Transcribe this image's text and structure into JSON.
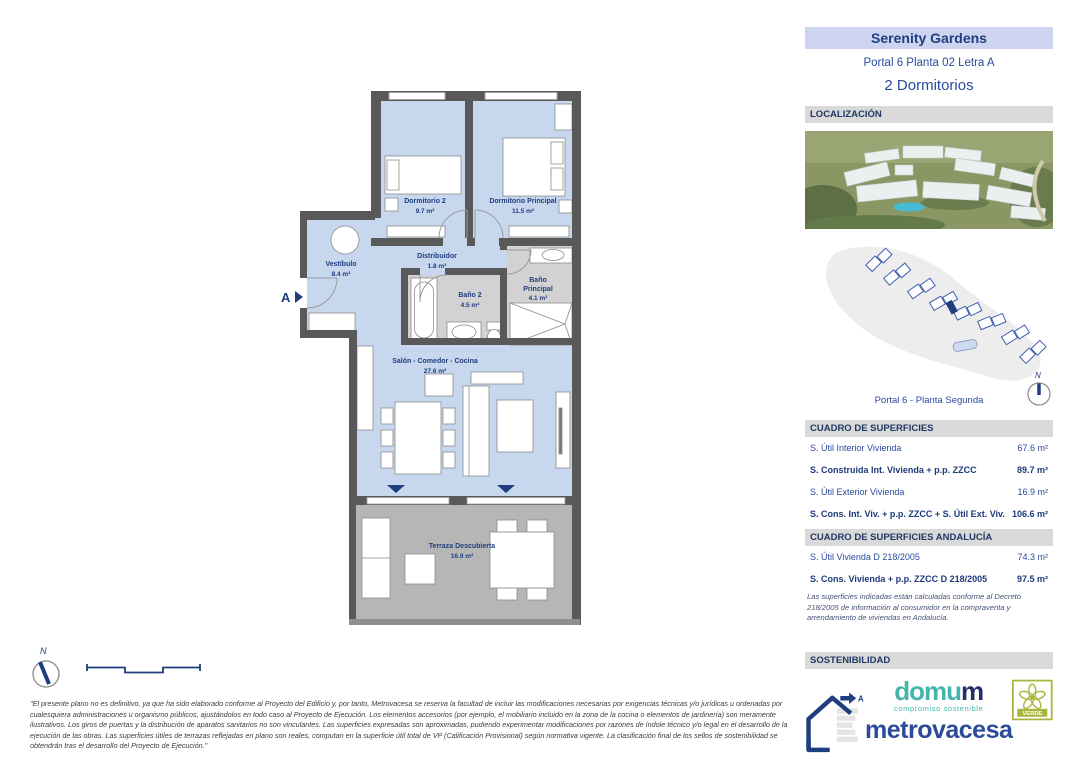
{
  "header": {
    "title": "Serenity Gardens",
    "subtitle": "Portal 6 Planta 02 Letra A",
    "bedrooms": "2 Dormitorios"
  },
  "localizacion": {
    "section_title": "LOCALIZACIÓN",
    "caption": "Portal 6 - Planta Segunda",
    "compass_label": "N"
  },
  "floor_plan": {
    "entrance_label": "A",
    "compass_label": "N",
    "rooms": [
      {
        "name": "Dormitorio 2",
        "area": "9.7 m²"
      },
      {
        "name": "Dormitorio Principal",
        "area": "11.5 m²"
      },
      {
        "name": "Vestíbulo",
        "area": "8.4 m²"
      },
      {
        "name": "Distribuidor",
        "area": "1.8 m²"
      },
      {
        "name": "Baño 2",
        "area": "4.5 m²"
      },
      {
        "name": "Baño Principal",
        "name_lines": [
          "Baño",
          "Principal"
        ],
        "area": "4.1 m²"
      },
      {
        "name": "Salón - Comedor - Cocina",
        "area": "27.6 m²"
      },
      {
        "name": "Terraza Descubierta",
        "area": "16.9 m²"
      }
    ]
  },
  "surfaces": {
    "section_title": "CUADRO DE SUPERFICIES",
    "rows": [
      {
        "label": "S. Útil Interior Vivienda",
        "value": "67.6 m²"
      },
      {
        "label": "S. Construida Int. Vivienda + p.p. ZZCC",
        "value": "89.7 m²"
      },
      {
        "label": "S. Útil Exterior Vivienda",
        "value": "16.9 m²"
      },
      {
        "label": "S. Cons. Int. Viv. + p.p. ZZCC + S. Útil Ext. Viv.",
        "value": "106.6 m²"
      }
    ]
  },
  "surfaces_andalucia": {
    "section_title": "CUADRO DE SUPERFICIES ANDALUCÍA",
    "rows": [
      {
        "label": "S. Útil Vivienda D 218/2005",
        "value": "74.3 m²"
      },
      {
        "label": "S. Cons. Vivienda + p.p. ZZCC D 218/2005",
        "value": "97.5 m²"
      }
    ],
    "note": "Las superficies indicadas están calculadas conforme al Decreto 218/2005 de información al consumidor en la compraventa y arrendamiento de viviendas en Andalucía."
  },
  "sostenibilidad": {
    "section_title": "SOSTENIBILIDAD",
    "energy_rating": "A",
    "domum_part1": "domu",
    "domum_part2": "m",
    "domum_tagline": "compromiso sostenible",
    "metrovacesa": "metrovacesa",
    "verde_badge": "VERDE"
  },
  "disclaimer": "\"El presente plano no es definitivo, ya que ha sido elaborado conforme al Proyecto del Edificio y, por tanto, Metrovacesa se reserva la facultad de incluir las modificaciones necesarias por exigencias técnicas y/o jurídicas u ordenadas por cualesquiera administraciones u organismo públicos, ajustándolos en todo caso al Proyecto de Ejecución. Los elementos accesorios (por ejemplo, el mobiliario incluido en la zona de la cocina o elementos de jardinería) son meramente ilustrativos. Los giros de puertas y la distribución de aparatos sanitarios no son vinculantes. Las superficies expresadas son aproximadas, pudiendo experimentar modificaciones por razones de índole técnico y/o legal en el desarrollo de la ejecución de las obras. Las superficies útiles de terrazas reflejadas en plano son reales, computan en la superficie útil total de VP (Calificación Provisional) según normativa vigente. La clasificación final de los sellos de sostenibilidad se obtendrán tras el desarrollo del Proyecto de Ejecución.\"",
  "colors": {
    "accent_navy": "#1f3e7e",
    "title_bg": "#ccd4f0",
    "section_header_bg": "#d9d9d9",
    "plan_room_blue": "#c7d7ee",
    "plan_wall_gray": "#595959",
    "bathroom_gray": "#d2d2d2",
    "terrace_gray": "#b6b6b6",
    "domum_teal": "#45b5ac",
    "metrovacesa_blue": "#2b4a9b",
    "verde_olive": "#a9b63d"
  }
}
